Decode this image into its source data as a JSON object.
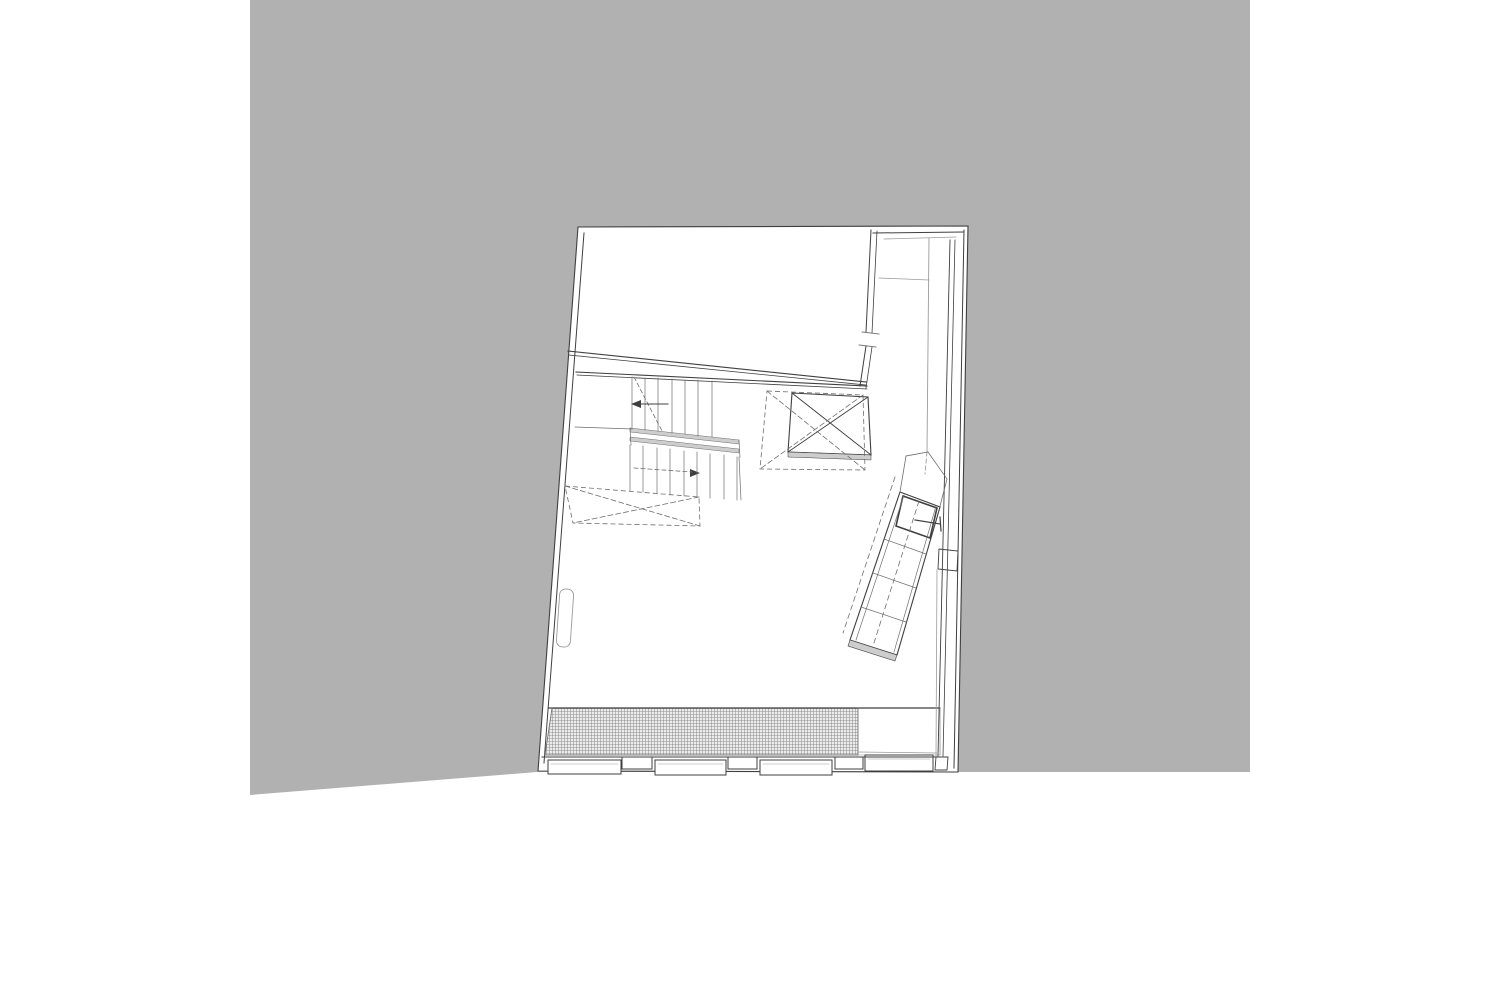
{
  "meta": {
    "description": "Architectural floor plan line drawing on gray backdrop",
    "canvas": {
      "width": 1500,
      "height": 1001,
      "page_bg": "#ffffff"
    }
  },
  "colors": {
    "backdrop": "#b1b1b1",
    "white": "#ffffff",
    "ink": "#3f3f3f",
    "mid": "#6e6e6e",
    "light": "#9b9b9b",
    "band": "#cdcdcd",
    "hatch_bg": "#ececec",
    "hatch_line": "#909090"
  },
  "drawing": {
    "polygons": [
      {
        "n": "gray-backdrop",
        "pts": [
          [
            250,
            0
          ],
          [
            1250,
            0
          ],
          [
            1250,
            772
          ],
          [
            537,
            772
          ],
          [
            250,
            795
          ]
        ],
        "fill": "backdrop",
        "sk": "",
        "w": 0,
        "dash": ""
      },
      {
        "n": "building-outline",
        "pts": [
          [
            578,
            227
          ],
          [
            968,
            226
          ],
          [
            958,
            772
          ],
          [
            538,
            771
          ]
        ],
        "fill": "white",
        "sk": "ink",
        "w": 1.1,
        "dash": ""
      },
      {
        "n": "grate-hatch-strip",
        "pts": [
          [
            552,
            708
          ],
          [
            858,
            708
          ],
          [
            858,
            755
          ],
          [
            545,
            755
          ]
        ],
        "fill": "hatch",
        "sk": "mid",
        "w": 0.5,
        "dash": ""
      },
      {
        "n": "entry-mat-strip",
        "pts": [
          [
            858,
            708
          ],
          [
            940,
            708
          ],
          [
            940,
            755
          ],
          [
            858,
            755
          ]
        ],
        "fill": "white",
        "sk": "light",
        "w": 0.6,
        "dash": ""
      },
      {
        "n": "stair-landing-band-1",
        "pts": [
          [
            630,
            428
          ],
          [
            739,
            440
          ],
          [
            739,
            444
          ],
          [
            630,
            432
          ]
        ],
        "fill": "band",
        "sk": "mid",
        "w": 0.5,
        "dash": ""
      },
      {
        "n": "stair-landing-band-2",
        "pts": [
          [
            630,
            437
          ],
          [
            739,
            449
          ],
          [
            739,
            453
          ],
          [
            630,
            441
          ]
        ],
        "fill": "band",
        "sk": "mid",
        "w": 0.5,
        "dash": ""
      },
      {
        "n": "stairwell-void-dashed",
        "pts": [
          [
            565,
            486
          ],
          [
            699,
            497
          ],
          [
            700,
            526
          ],
          [
            573,
            523
          ]
        ],
        "fill": "",
        "sk": "mid",
        "w": 0.8,
        "dash": "5 3"
      },
      {
        "n": "elevator-shaft-box",
        "pts": [
          [
            792,
            393
          ],
          [
            868,
            397
          ],
          [
            871,
            455
          ],
          [
            788,
            452
          ]
        ],
        "fill": "white",
        "sk": "ink",
        "w": 1.1,
        "dash": ""
      },
      {
        "n": "elevator-shaft-sill",
        "pts": [
          [
            788,
            452
          ],
          [
            871,
            455
          ],
          [
            871,
            460
          ],
          [
            788,
            457
          ]
        ],
        "fill": "band",
        "sk": "ink",
        "w": 0.5,
        "dash": ""
      },
      {
        "n": "elevator-dashed-box",
        "pts": [
          [
            767,
            391
          ],
          [
            863,
            395
          ],
          [
            865,
            470
          ],
          [
            760,
            469
          ]
        ],
        "fill": "",
        "sk": "mid",
        "w": 0.8,
        "dash": "5 3"
      },
      {
        "n": "angled-stair-body",
        "pts": [
          [
            900,
            492
          ],
          [
            940,
            507
          ],
          [
            897,
            655
          ],
          [
            850,
            640
          ]
        ],
        "fill": "white",
        "sk": "ink",
        "w": 1.1,
        "dash": ""
      },
      {
        "n": "angled-stair-platform",
        "pts": [
          [
            903,
            496
          ],
          [
            937,
            508
          ],
          [
            930,
            538
          ],
          [
            896,
            526
          ]
        ],
        "fill": "",
        "sk": "ink",
        "w": 1.6,
        "dash": ""
      },
      {
        "n": "angled-stair-end-band",
        "pts": [
          [
            850,
            640
          ],
          [
            897,
            655
          ],
          [
            895,
            661
          ],
          [
            848,
            646
          ]
        ],
        "fill": "band",
        "sk": "ink",
        "w": 0.6,
        "dash": ""
      },
      {
        "n": "right-wall-niche",
        "pts": [
          [
            939,
            549
          ],
          [
            958,
            551
          ],
          [
            957,
            571
          ],
          [
            938,
            569
          ]
        ],
        "fill": "white",
        "sk": "ink",
        "w": 0.9,
        "dash": ""
      },
      {
        "n": "window-sill-1",
        "pts": [
          [
            548,
            760
          ],
          [
            621,
            760
          ],
          [
            621,
            774
          ],
          [
            548,
            774
          ]
        ],
        "fill": "white",
        "sk": "ink",
        "w": 1,
        "dash": ""
      },
      {
        "n": "window-pier-1",
        "pts": [
          [
            622,
            757
          ],
          [
            652,
            757
          ],
          [
            652,
            769
          ],
          [
            622,
            769
          ]
        ],
        "fill": "white",
        "sk": "ink",
        "w": 1,
        "dash": ""
      },
      {
        "n": "window-sill-2",
        "pts": [
          [
            655,
            760
          ],
          [
            726,
            760
          ],
          [
            726,
            775
          ],
          [
            655,
            775
          ]
        ],
        "fill": "white",
        "sk": "ink",
        "w": 1,
        "dash": ""
      },
      {
        "n": "window-pier-2",
        "pts": [
          [
            728,
            757
          ],
          [
            757,
            757
          ],
          [
            757,
            769
          ],
          [
            728,
            769
          ]
        ],
        "fill": "white",
        "sk": "ink",
        "w": 1,
        "dash": ""
      },
      {
        "n": "window-sill-3",
        "pts": [
          [
            760,
            760
          ],
          [
            832,
            760
          ],
          [
            832,
            775
          ],
          [
            760,
            775
          ]
        ],
        "fill": "white",
        "sk": "ink",
        "w": 1,
        "dash": ""
      },
      {
        "n": "window-pier-3",
        "pts": [
          [
            835,
            757
          ],
          [
            863,
            757
          ],
          [
            863,
            769
          ],
          [
            835,
            769
          ]
        ],
        "fill": "white",
        "sk": "ink",
        "w": 1,
        "dash": ""
      },
      {
        "n": "entry-threshold",
        "pts": [
          [
            865,
            755
          ],
          [
            933,
            755
          ],
          [
            933,
            771
          ],
          [
            865,
            771
          ]
        ],
        "fill": "white",
        "sk": "ink",
        "w": 1,
        "dash": ""
      },
      {
        "n": "bottom-right-corner-pier",
        "pts": [
          [
            936,
            757
          ],
          [
            948,
            757
          ],
          [
            947,
            770
          ],
          [
            935,
            770
          ]
        ],
        "fill": "white",
        "sk": "ink",
        "w": 0.9,
        "dash": ""
      },
      {
        "n": "stair-arrow-head-up",
        "pts": [
          [
            631,
            404
          ],
          [
            641,
            400
          ],
          [
            641,
            408
          ]
        ],
        "fill": "ink",
        "sk": "",
        "w": 0,
        "dash": ""
      },
      {
        "n": "stair-arrow-head-down",
        "pts": [
          [
            700,
            473
          ],
          [
            690,
            469
          ],
          [
            690,
            477
          ]
        ],
        "fill": "ink",
        "sk": "",
        "w": 0,
        "dash": ""
      }
    ],
    "lines": [
      [
        584,
        233,
        544,
        763,
        "ink",
        1,
        ""
      ],
      [
        542,
        757,
        939,
        757,
        "ink",
        1,
        ""
      ],
      [
        873,
        233,
        963,
        232,
        "ink",
        1,
        ""
      ],
      [
        871,
        230,
        866,
        332,
        "ink",
        1,
        ""
      ],
      [
        877,
        231,
        872,
        333,
        "ink",
        0.8,
        ""
      ],
      [
        866,
        346,
        860,
        386,
        "ink",
        1,
        ""
      ],
      [
        872,
        347,
        866,
        388,
        "ink",
        0.8,
        ""
      ],
      [
        964,
        230,
        954,
        768,
        "ink",
        1,
        ""
      ],
      [
        950,
        240,
        938,
        756,
        "ink",
        0.9,
        ""
      ],
      [
        955,
        240,
        943,
        756,
        "ink",
        0.8,
        ""
      ],
      [
        568,
        351,
        866,
        382,
        "ink",
        1.1,
        ""
      ],
      [
        569,
        355,
        866,
        385,
        "ink",
        0.8,
        ""
      ],
      [
        576,
        372,
        867,
        386,
        "ink",
        1.1,
        ""
      ],
      [
        577,
        375,
        867,
        389,
        "ink",
        0.8,
        ""
      ],
      [
        575,
        427,
        632,
        429,
        "mid",
        0.8,
        ""
      ],
      [
        549,
        708,
        940,
        708,
        "ink",
        1.2,
        ""
      ],
      [
        545,
        755,
        858,
        755,
        "mid",
        0.8,
        ""
      ],
      [
        858,
        708,
        858,
        755,
        "mid",
        0.8,
        ""
      ],
      [
        940,
        708,
        940,
        755,
        "light",
        0.8,
        ""
      ],
      [
        858,
        752,
        938,
        753,
        "light",
        0.7,
        ""
      ],
      [
        552,
        708,
        545,
        755,
        "mid",
        0.8,
        ""
      ],
      [
        884,
        239,
        956,
        237,
        "light",
        0.8,
        ""
      ],
      [
        879,
        278,
        929,
        280,
        "light",
        0.8,
        ""
      ],
      [
        929,
        238,
        927,
        452,
        "light",
        0.9,
        ""
      ],
      [
        927,
        452,
        925,
        474,
        "light",
        0.9,
        "4 3"
      ],
      [
        862,
        332,
        879,
        334,
        "mid",
        0.9,
        ""
      ],
      [
        859,
        345,
        876,
        347,
        "mid",
        0.9,
        ""
      ],
      [
        632,
        377,
        632,
        428,
        "mid",
        0.7,
        ""
      ],
      [
        645,
        378,
        645,
        430,
        "mid",
        0.7,
        ""
      ],
      [
        658,
        378,
        658,
        431,
        "mid",
        0.7,
        ""
      ],
      [
        672,
        379,
        672,
        433,
        "mid",
        0.7,
        ""
      ],
      [
        685,
        380,
        685,
        434,
        "mid",
        0.7,
        ""
      ],
      [
        698,
        380,
        698,
        436,
        "mid",
        0.7,
        ""
      ],
      [
        712,
        381,
        712,
        437,
        "mid",
        0.7,
        ""
      ],
      [
        630,
        428,
        631,
        445,
        "mid",
        0.7,
        ""
      ],
      [
        739,
        440,
        740,
        457,
        "mid",
        0.7,
        ""
      ],
      [
        630,
        445,
        630,
        491,
        "mid",
        0.7,
        ""
      ],
      [
        643,
        446,
        643,
        492,
        "mid",
        0.7,
        ""
      ],
      [
        657,
        448,
        657,
        494,
        "mid",
        0.7,
        ""
      ],
      [
        670,
        449,
        670,
        495,
        "mid",
        0.7,
        ""
      ],
      [
        684,
        451,
        684,
        496,
        "mid",
        0.7,
        ""
      ],
      [
        697,
        452,
        697,
        497,
        "mid",
        0.7,
        ""
      ],
      [
        710,
        454,
        710,
        498,
        "mid",
        0.7,
        ""
      ],
      [
        724,
        455,
        724,
        499,
        "mid",
        0.7,
        ""
      ],
      [
        737,
        457,
        737,
        500,
        "mid",
        0.7,
        ""
      ],
      [
        739,
        457,
        741,
        500,
        "mid",
        0.7,
        ""
      ],
      [
        634,
        377,
        662,
        431,
        "mid",
        0.8,
        "4 3"
      ],
      [
        668,
        404,
        634,
        404,
        "ink",
        1,
        ""
      ],
      [
        634,
        468,
        692,
        472,
        "mid",
        0.8,
        "4 3"
      ],
      [
        565,
        486,
        700,
        526,
        "mid",
        0.8,
        "5 3"
      ],
      [
        699,
        497,
        573,
        523,
        "mid",
        0.8,
        "5 3"
      ],
      [
        792,
        393,
        871,
        455,
        "ink",
        0.9,
        ""
      ],
      [
        868,
        397,
        788,
        452,
        "ink",
        0.9,
        ""
      ],
      [
        767,
        391,
        865,
        470,
        "mid",
        0.8,
        "5 3"
      ],
      [
        863,
        395,
        760,
        469,
        "mid",
        0.8,
        "5 3"
      ],
      [
        904,
        495,
        856,
        640,
        "mid",
        0.7,
        ""
      ],
      [
        936,
        506,
        894,
        652,
        "mid",
        0.7,
        ""
      ],
      [
        884,
        539,
        926,
        554,
        "mid",
        0.7,
        ""
      ],
      [
        873,
        573,
        916,
        588,
        "mid",
        0.7,
        ""
      ],
      [
        861,
        607,
        906,
        622,
        "mid",
        0.7,
        ""
      ],
      [
        919,
        501,
        873,
        646,
        "mid",
        0.8,
        "5 4"
      ],
      [
        915,
        520,
        940,
        524,
        "ink",
        1.2,
        ""
      ],
      [
        940,
        517,
        941,
        531,
        "ink",
        1.2,
        ""
      ],
      [
        895,
        477,
        843,
        633,
        "mid",
        0.8,
        "5 4"
      ],
      [
        928,
        452,
        906,
        456,
        "mid",
        0.8,
        ""
      ],
      [
        906,
        456,
        900,
        492,
        "mid",
        0.8,
        ""
      ],
      [
        928,
        452,
        947,
        479,
        "mid",
        0.8,
        ""
      ],
      [
        947,
        479,
        940,
        506,
        "mid",
        0.8,
        ""
      ],
      [
        937,
        570,
        936,
        756,
        "light",
        0.8,
        ""
      ],
      [
        551,
        764,
        618,
        764,
        "light",
        0.6,
        ""
      ],
      [
        658,
        764,
        723,
        764,
        "light",
        0.6,
        ""
      ],
      [
        763,
        764,
        829,
        764,
        "light",
        0.6,
        ""
      ],
      [
        868,
        759,
        930,
        759,
        "light",
        0.6,
        ""
      ]
    ],
    "rounded_rects": [
      {
        "n": "left-wall-radiator",
        "cx": 565,
        "cy": 618,
        "w": 14,
        "h": 58,
        "rx": 6,
        "rot": 4,
        "sk": "light",
        "wd": 0.9
      }
    ]
  }
}
